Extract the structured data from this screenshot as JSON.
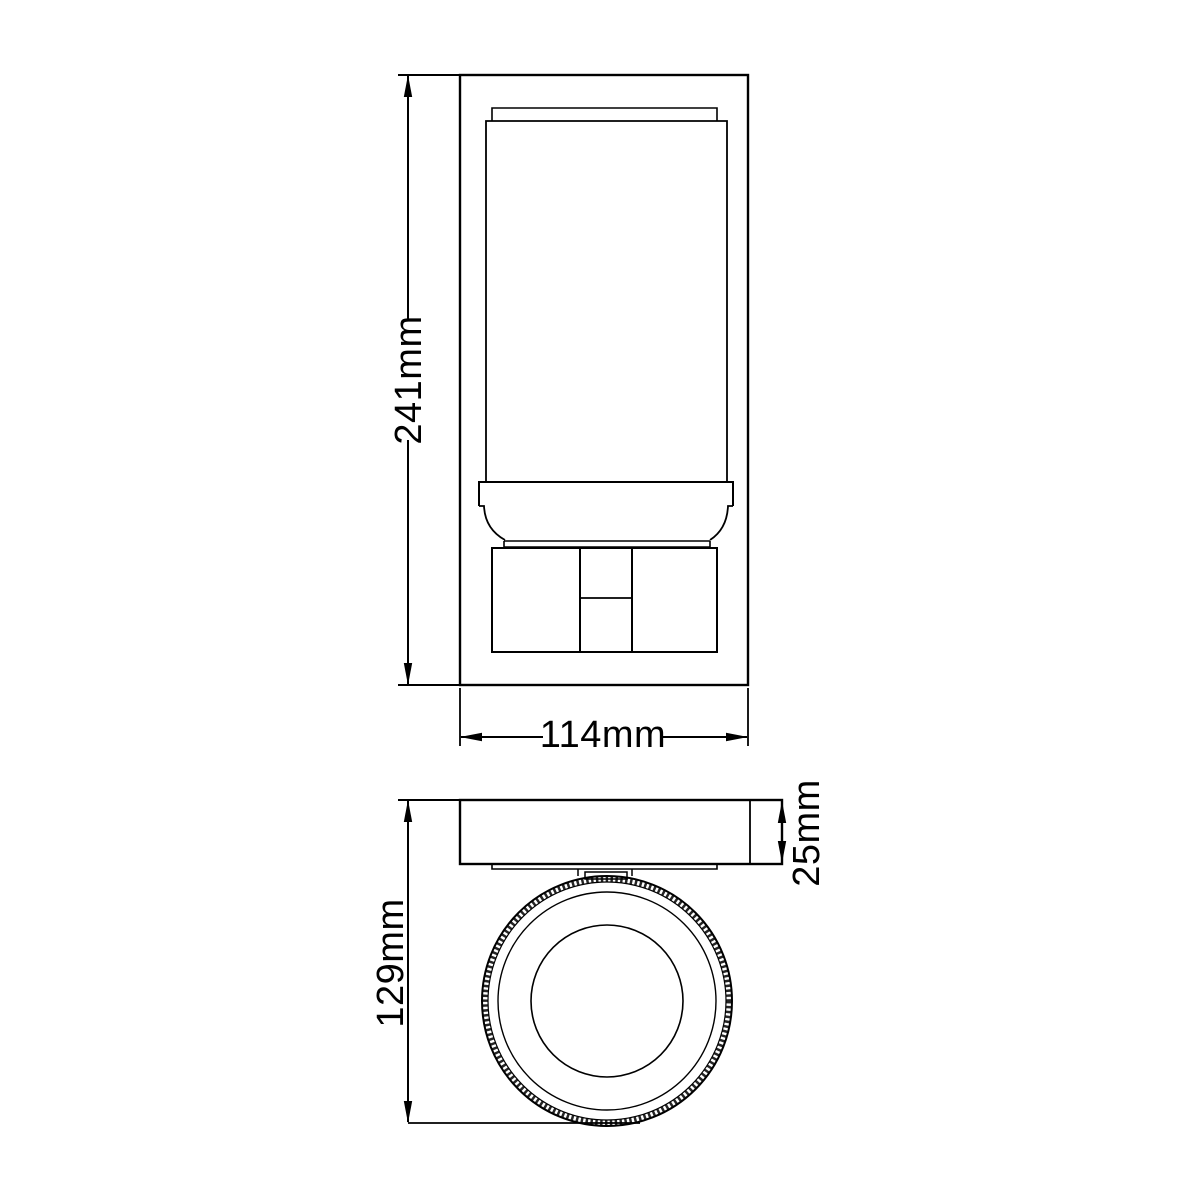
{
  "drawing": {
    "front_view": {
      "height_label": "241mm",
      "width_label": "114mm"
    },
    "top_view": {
      "depth_label": "129mm",
      "plate_thickness_label": "25mm"
    }
  },
  "colors": {
    "line": "#000000",
    "text": "#000000",
    "background": "#ffffff"
  }
}
